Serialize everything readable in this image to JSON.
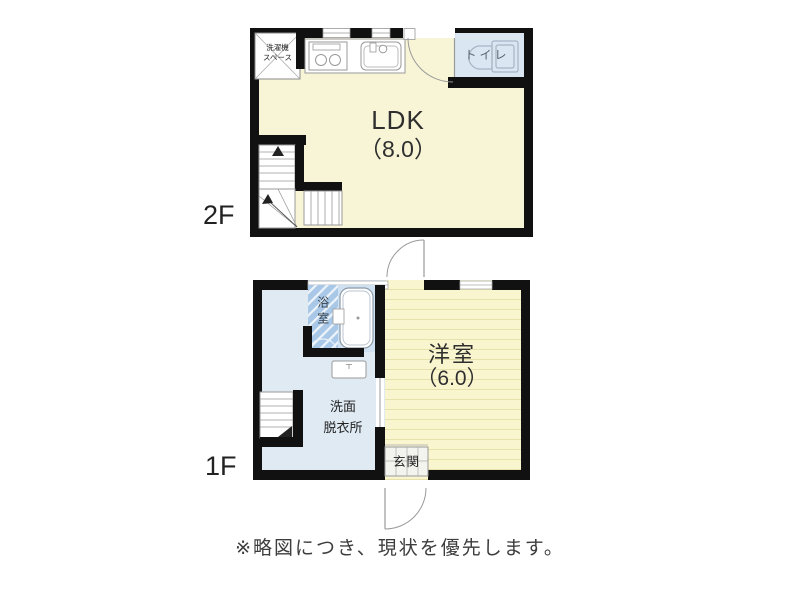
{
  "plan": {
    "note": "※略図につき、現状を優先します。",
    "floor2": {
      "label": "2F",
      "ldk_name": "LDK",
      "ldk_size": "（8.0）",
      "toilet": "トイレ",
      "washer_line1": "洗濯機",
      "washer_line2": "スペース"
    },
    "floor1": {
      "label": "1F",
      "room_name": "洋室",
      "room_size": "（6.0）",
      "bath": "浴室",
      "senmen_line1": "洗面",
      "senmen_line2": "脱衣所",
      "genkan": "玄関"
    },
    "colors": {
      "wall": "#111111",
      "ldk_floor": "#f8f5d6",
      "western_room_floor": "#f9f6cf",
      "western_room_lines": "#e7e2ab",
      "washroom_floor": "#dfeaf3",
      "toilet_floor": "#dae7f3",
      "bath_tile": "#a9c8e8",
      "bathtub_area": "#cfe1f0",
      "fixture_line": "#999999"
    }
  }
}
